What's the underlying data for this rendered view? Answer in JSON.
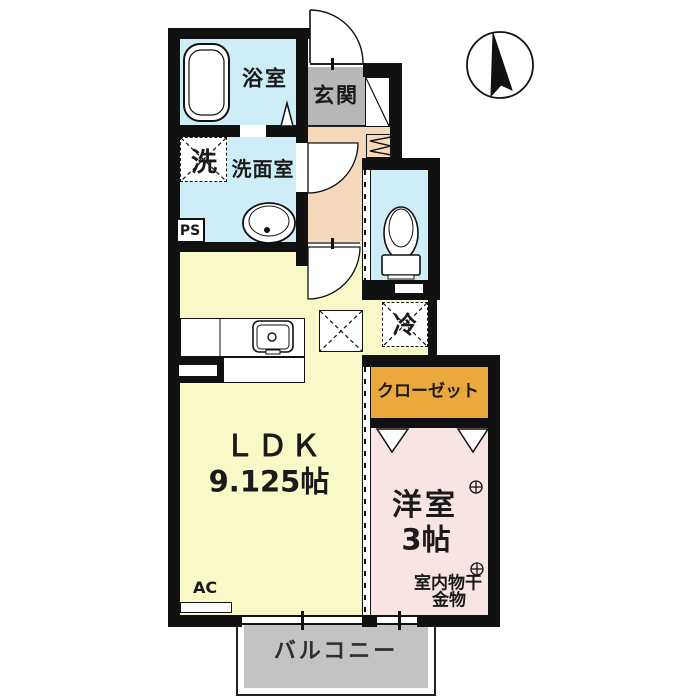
{
  "title": "1LDK apartment floor plan",
  "compass": {
    "direction_label": "N",
    "description": "north-arrow"
  },
  "rooms": {
    "bath": {
      "label": "浴室"
    },
    "entrance": {
      "label": "玄関"
    },
    "washer_box": {
      "label": "洗"
    },
    "washroom": {
      "label": "洗面室"
    },
    "pipe_space": {
      "label": "PS"
    },
    "refrigerator": {
      "label": "冷"
    },
    "ldk": {
      "label": "ＬＤＫ",
      "size": "9.125帖"
    },
    "closet": {
      "label": "クローゼット"
    },
    "western_room": {
      "label": "洋室",
      "size": "3帖"
    },
    "laundry_hardware": {
      "label_line1": "室内物干",
      "label_line2": "金物",
      "symbol": "crosshair-anchor"
    },
    "air_conditioner": {
      "label": "AC"
    },
    "balcony": {
      "label": "バルコニー"
    }
  },
  "colors": {
    "wall": "#111111",
    "wet_area_cyan": "#cdeef6",
    "hall_peach": "#f6d8ba",
    "entrance_gray": "#b7b7b7",
    "ldk_yellow": "#f9f9c8",
    "closet_orange": "#eaa83d",
    "western_room_pink": "#f9e4e4",
    "balcony_gray": "#c3c3c3"
  }
}
